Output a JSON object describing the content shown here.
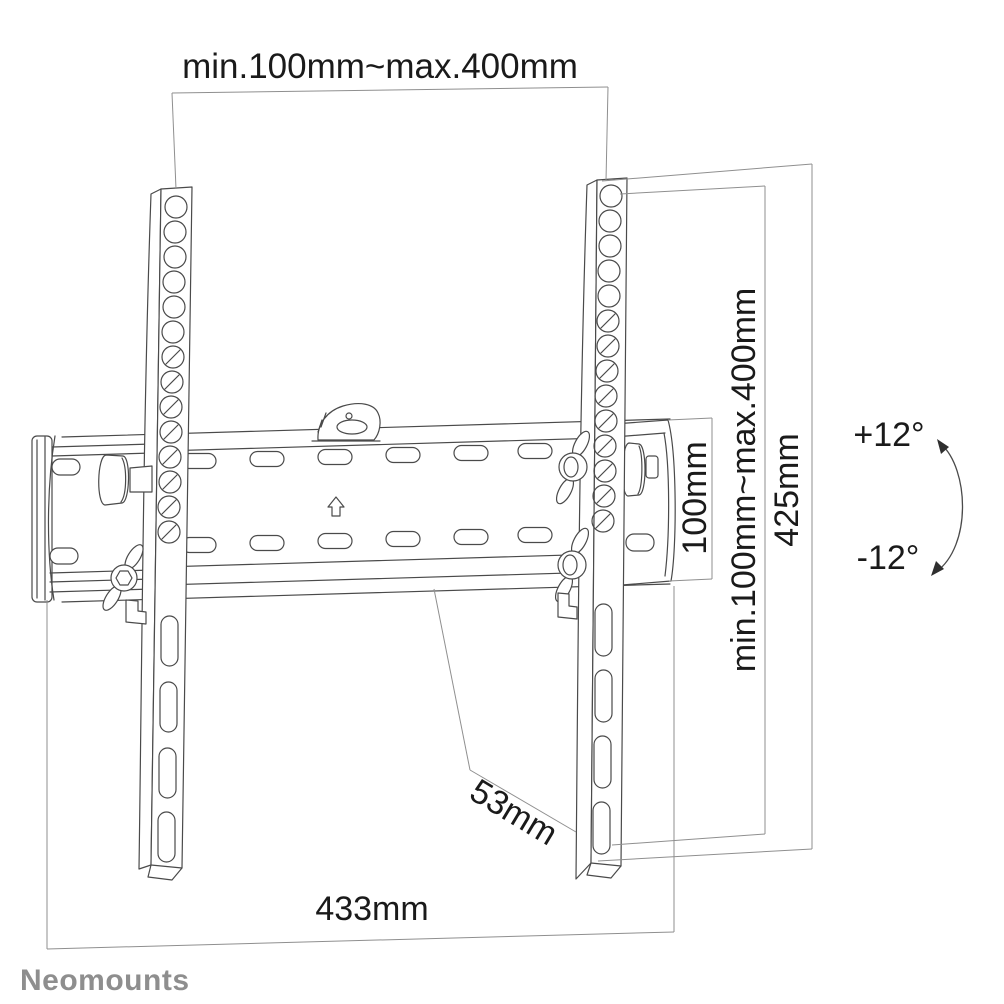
{
  "page": {
    "background": "#ffffff"
  },
  "brand": {
    "name": "Neomounts",
    "logo_color": "#8e8e8e"
  },
  "dimensions": {
    "top_width_range": "min.100mm~max.400mm",
    "plate_height": "100mm",
    "vesa_vertical_range": "min.100mm~max.400mm",
    "bracket_height": "425mm",
    "depth": "53mm",
    "overall_width": "433mm"
  },
  "tilt": {
    "up": "+12°",
    "down": "-12°"
  },
  "colors": {
    "part_line": "#4a4a4a",
    "dimension_line": "#8f8f8f",
    "label_text": "#1a1a1a",
    "logo_text": "#8e8e8e",
    "background": "#ffffff"
  },
  "icons": {
    "up-arrow-icon": "hollow up arrow marking mounting direction on wall plate",
    "spirit-level-icon": "bubble spirit level dome on top of wall plate",
    "tilt-arc-icon": "curved double-headed arrow showing tilt range"
  }
}
